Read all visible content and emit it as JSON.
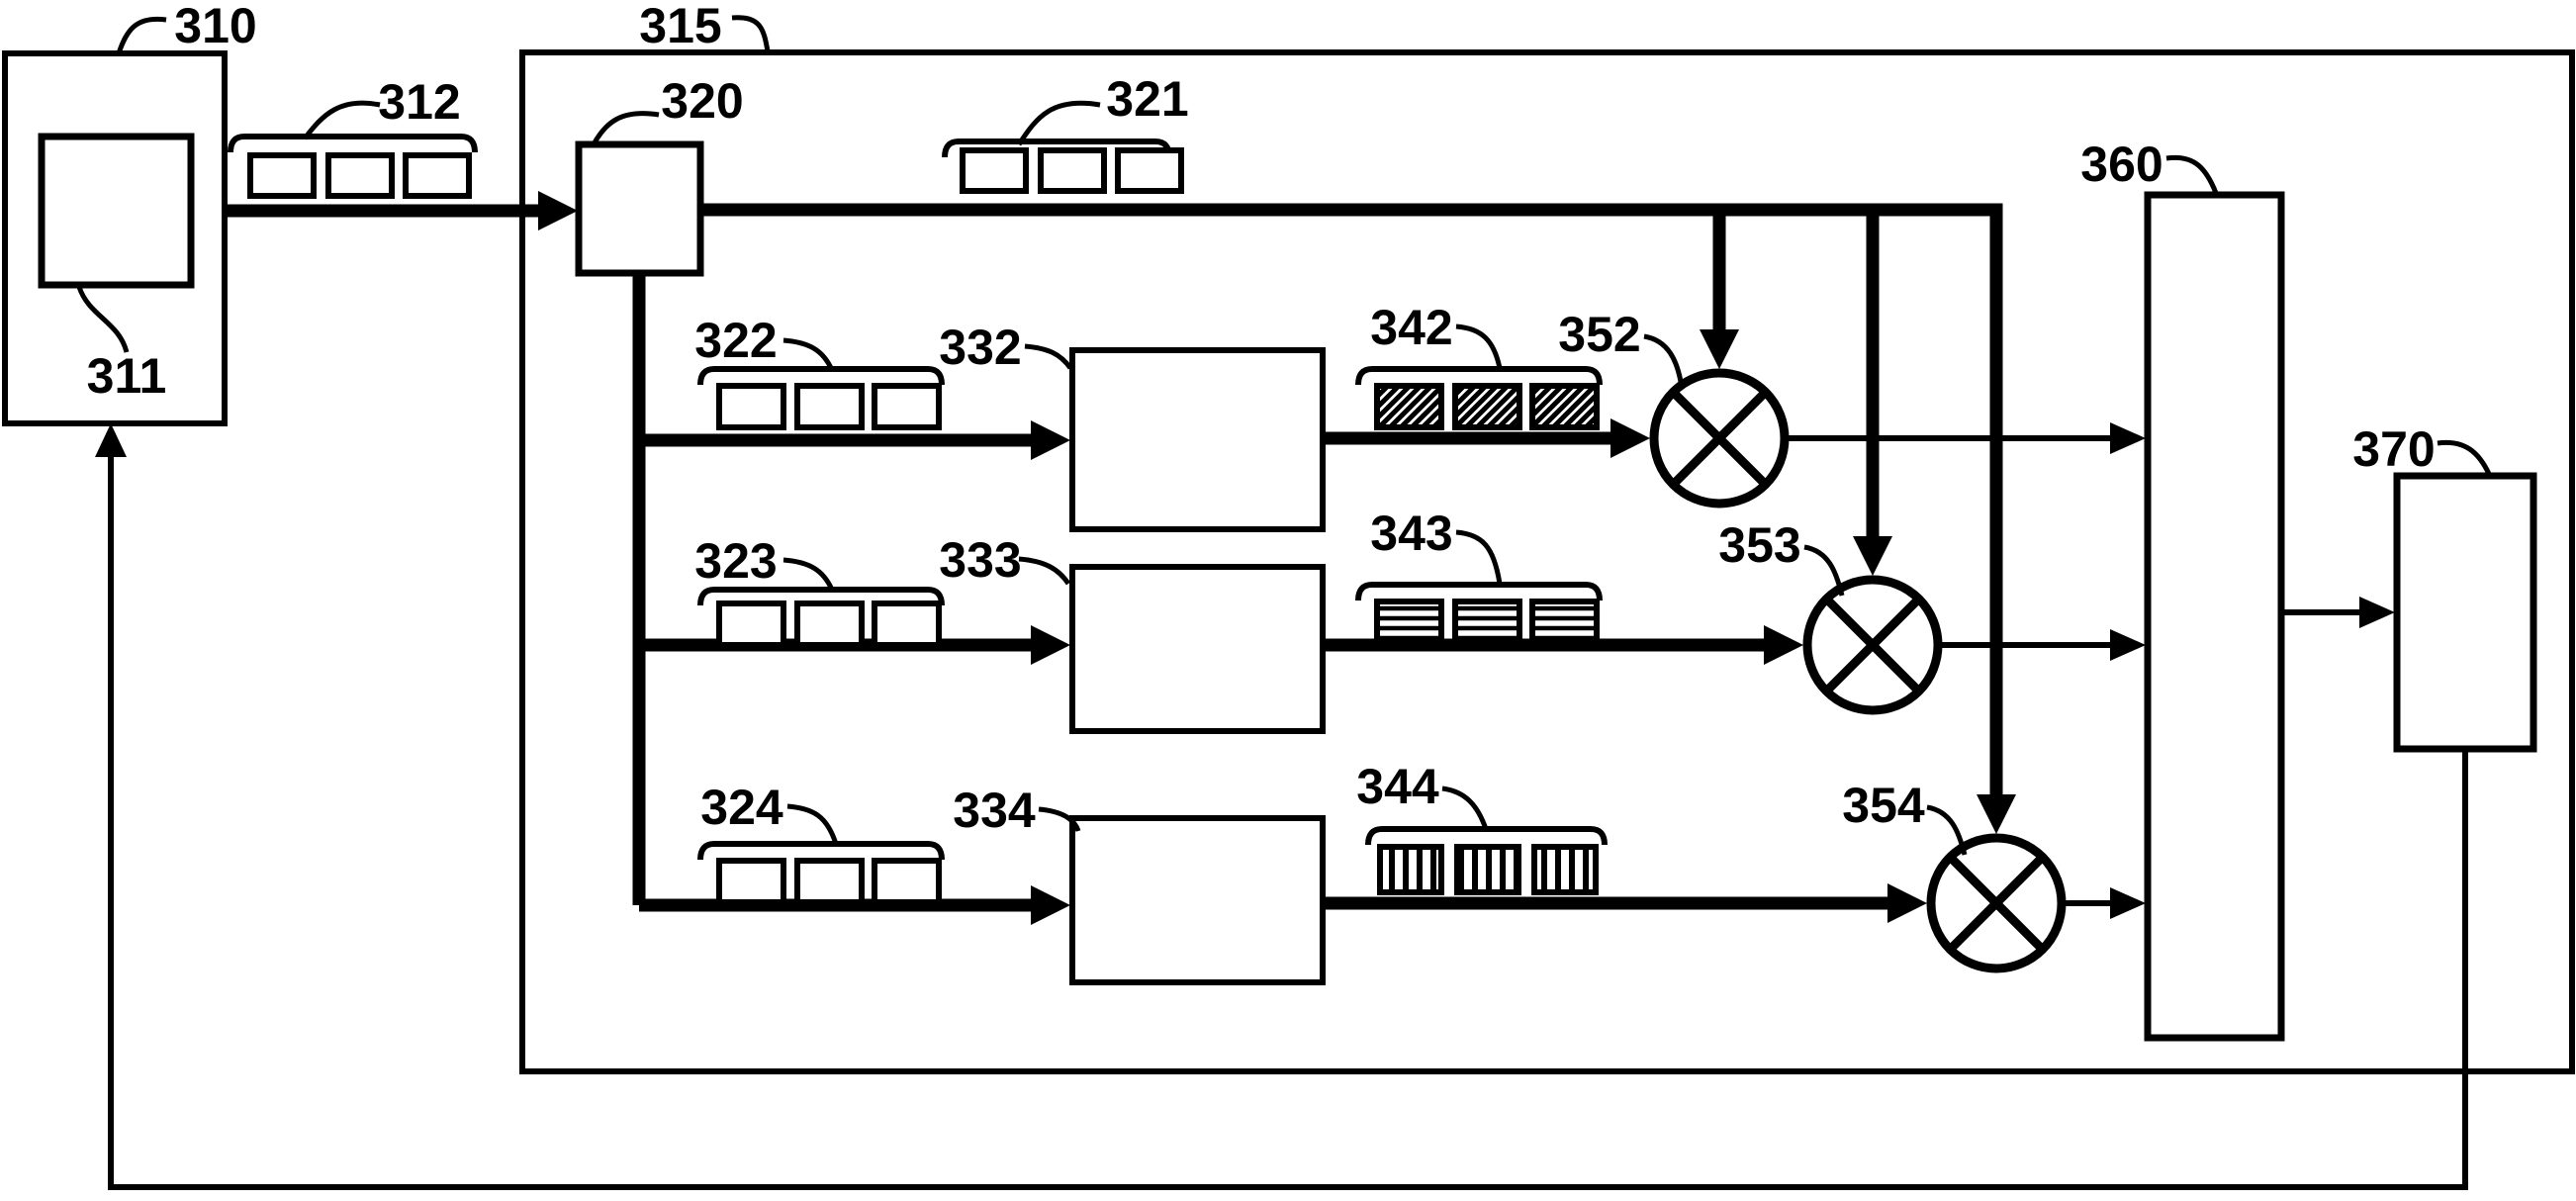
{
  "figure": {
    "type": "patent-block-diagram",
    "colors": {
      "background": "#ffffff",
      "ink": "#000000"
    },
    "labels": {
      "l310": "310",
      "l311": "311",
      "l312": "312",
      "l315": "315",
      "l320": "320",
      "l321": "321",
      "l322": "322",
      "l323": "323",
      "l324": "324",
      "l332": "332",
      "l333": "333",
      "l334": "334",
      "l342": "342",
      "l343": "343",
      "l344": "344",
      "l352": "352",
      "l353": "353",
      "l354": "354",
      "l360": "360",
      "l370": "370"
    },
    "icons": {
      "queues_plain": [
        "312",
        "321",
        "322",
        "323",
        "324"
      ],
      "queues_hatched": [
        {
          "id": "342",
          "hatch": "diagonal"
        },
        {
          "id": "343",
          "hatch": "horizontal"
        },
        {
          "id": "344",
          "hatch": "vertical"
        }
      ],
      "multipliers": [
        "352",
        "353",
        "354"
      ]
    }
  }
}
